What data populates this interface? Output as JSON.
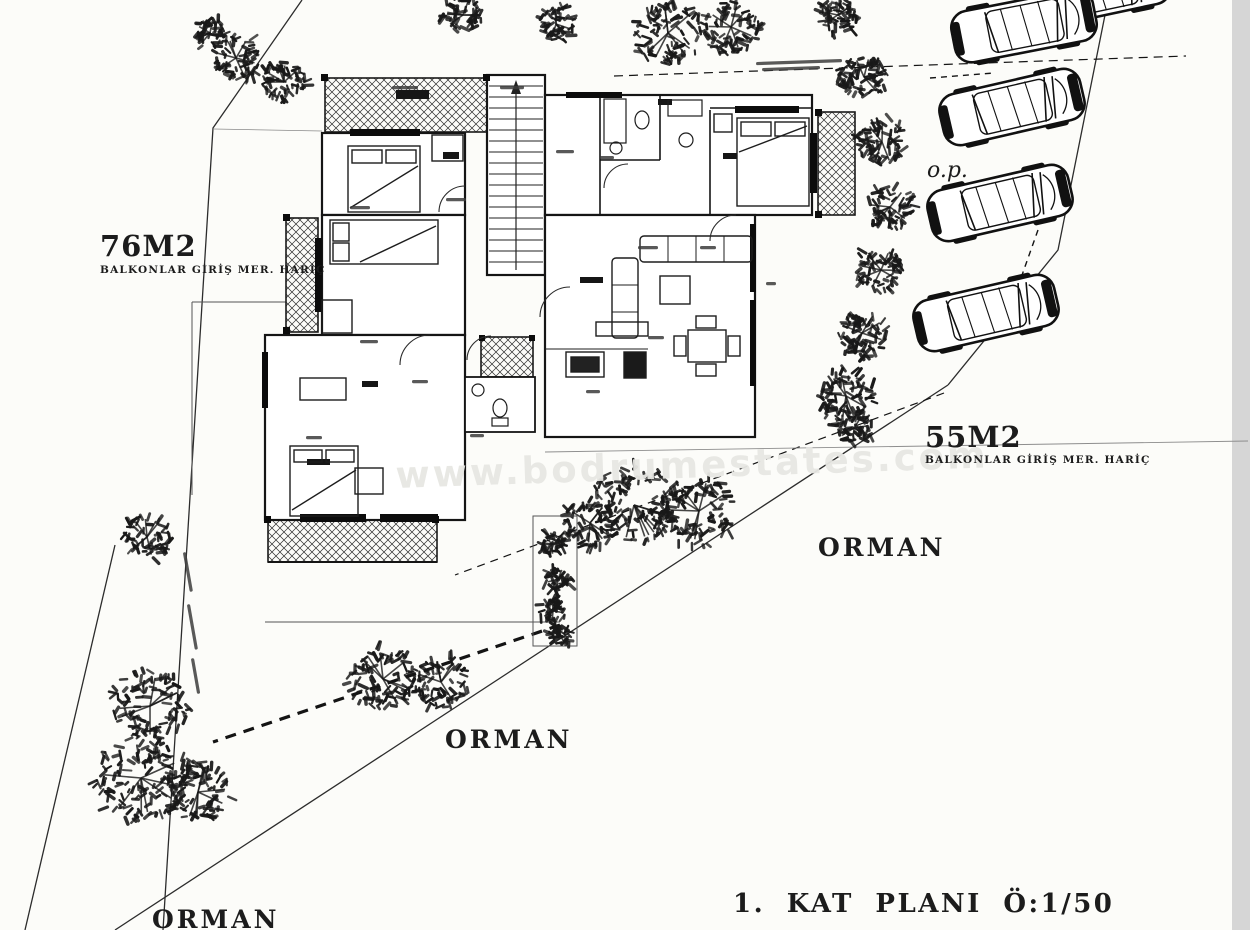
{
  "drawing": {
    "plan_title": "1.  KAT  PLANI  Ö:1/50",
    "watermark": "www.bodrumestates.com",
    "area_left": {
      "label": "76M2",
      "note": "BALKONLAR GİRİŞ MER. HARİÇ"
    },
    "area_right": {
      "label": "55M2",
      "note": "BALKONLAR GİRİŞ MER. HARİÇ"
    },
    "parking_label": "o.p.",
    "forest_labels": [
      "ORMAN",
      "ORMAN",
      "ORMAN"
    ],
    "colors": {
      "ink": "#1c1c1c",
      "paper": "#fcfcf9",
      "edge_strip": "#d6d6d6"
    }
  }
}
